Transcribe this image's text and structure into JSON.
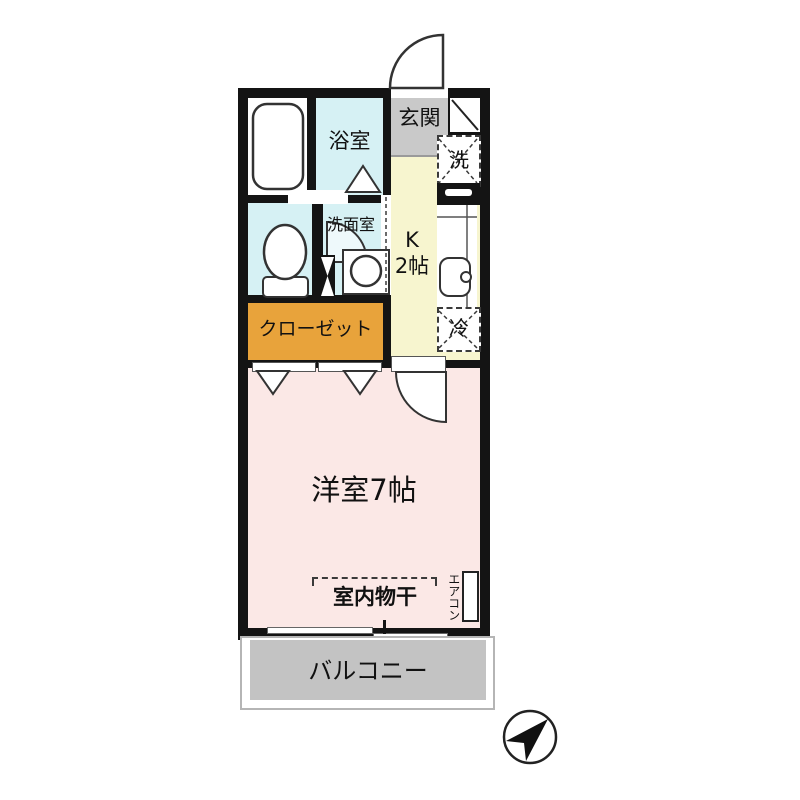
{
  "floorplan": {
    "rooms": {
      "bathroom": {
        "label": "浴室"
      },
      "washroom": {
        "label": "洗面室"
      },
      "entrance": {
        "label": "玄関"
      },
      "kitchen": {
        "label_line1": "K",
        "label_line2": "2帖"
      },
      "closet": {
        "label": "クローゼット"
      },
      "western_room": {
        "label": "洋室7帖"
      },
      "balcony": {
        "label": "バルコニー"
      }
    },
    "fixtures": {
      "washer_space": {
        "label": "洗"
      },
      "fridge_space": {
        "label": "冷"
      },
      "aircon": {
        "label": "エアコン"
      },
      "indoor_drying": {
        "label": "室内物干"
      }
    },
    "icons": {
      "north_arrow": "north-arrow-icon"
    },
    "colors": {
      "wall": "#141414",
      "wet_area_blue": "#d6f1f4",
      "kitchen_yellow": "#f7f5cf",
      "room_pink": "#fbe8e6",
      "closet_orange": "#e8a33b",
      "entrance_gray": "#c9c9c9",
      "balcony_gray": "#c3c3c3"
    }
  }
}
